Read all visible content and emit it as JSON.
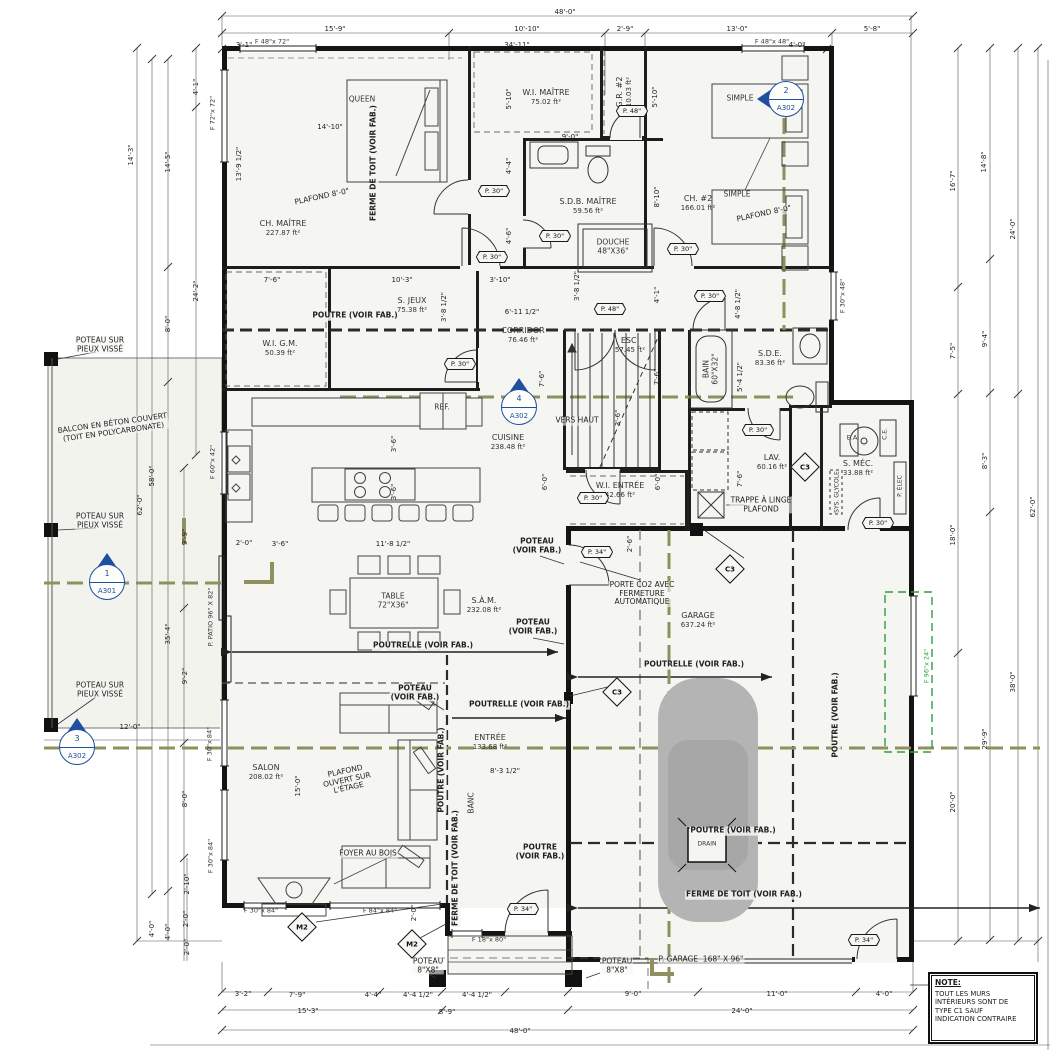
{
  "note": {
    "title": "NOTE:",
    "body": "TOUT LES MURS\nINTÉRIEURS SONT DE\nTYPE C1 SAUF\nINDICATION CONTRAIRE"
  },
  "colors": {
    "accent_blue": "#1e4fa0",
    "section_tan": "#90905e",
    "future_green": "#2e9e3e",
    "wall_black": "#141414",
    "car_gray": "#b4b4b4"
  },
  "rooms": [
    {
      "id": "ch-maitre",
      "name": "CH. MAÎTRE",
      "area": "227.87 ft²",
      "x": 283,
      "y": 228
    },
    {
      "id": "wi-maitre",
      "name": "W.I. MAÎTRE",
      "area": "75.02 ft²",
      "x": 546,
      "y": 97
    },
    {
      "id": "gr-2",
      "name": "G.R. #2",
      "area": "10.03 ft²",
      "x": 624,
      "y": 92,
      "r": -90
    },
    {
      "id": "ch-2",
      "name": "CH. #2",
      "area": "166.01 ft²",
      "x": 698,
      "y": 203
    },
    {
      "id": "sdb-maitre",
      "name": "S.D.B. MAÎTRE",
      "area": "59.56 ft²",
      "x": 588,
      "y": 206
    },
    {
      "id": "s-jeux",
      "name": "S. JEUX",
      "area": "75.38 ft²",
      "x": 412,
      "y": 305
    },
    {
      "id": "wi-gm",
      "name": "W.I. G.M.",
      "area": "50.39 ft²",
      "x": 280,
      "y": 348
    },
    {
      "id": "corridor",
      "name": "CORRIDOR",
      "area": "76.46 ft²",
      "x": 523,
      "y": 335
    },
    {
      "id": "esc",
      "name": "ESC.",
      "area": "57.45 ft²",
      "x": 630,
      "y": 345
    },
    {
      "id": "sde",
      "name": "S.D.E.",
      "area": "83.36 ft²",
      "x": 770,
      "y": 358
    },
    {
      "id": "cuisine",
      "name": "CUISINE",
      "area": "238.48 ft²",
      "x": 508,
      "y": 442
    },
    {
      "id": "wi-entree",
      "name": "W.I. ENTRÉE",
      "area": "42.66 ft²",
      "x": 620,
      "y": 490
    },
    {
      "id": "lav",
      "name": "LAV.",
      "area": "60.16 ft²",
      "x": 772,
      "y": 462
    },
    {
      "id": "s-mec",
      "name": "S. MÉC.",
      "area": "33.88 ft²",
      "x": 858,
      "y": 468
    },
    {
      "id": "sam",
      "name": "S.À.M.",
      "area": "232.08 ft²",
      "x": 484,
      "y": 605
    },
    {
      "id": "garage",
      "name": "GARAGE",
      "area": "637.24 ft²",
      "x": 698,
      "y": 620
    },
    {
      "id": "salon",
      "name": "SALON",
      "area": "208.02 ft²",
      "x": 266,
      "y": 772
    },
    {
      "id": "entree",
      "name": "ENTRÉE",
      "area": "133.68 ft²",
      "x": 490,
      "y": 742
    }
  ],
  "annotations": [
    {
      "t": "POUTRE (VOIR FAB.)",
      "x": 355,
      "y": 316
    },
    {
      "t": "POUTRE (VOIR FAB.)",
      "x": 442,
      "y": 770,
      "r": -90
    },
    {
      "t": "POUTRE\n(VOIR FAB.)",
      "x": 540,
      "y": 852
    },
    {
      "t": "POUTRE (VOIR FAB.)",
      "x": 836,
      "y": 715,
      "r": -90
    },
    {
      "t": "POUTRE (VOIR FAB.)",
      "x": 733,
      "y": 831
    },
    {
      "t": "POUTRELLE (VOIR FAB.)",
      "x": 423,
      "y": 646
    },
    {
      "t": "POUTRELLE (VOIR FAB.)",
      "x": 519,
      "y": 705
    },
    {
      "t": "POUTRELLE (VOIR FAB.)",
      "x": 694,
      "y": 665
    },
    {
      "t": "FERME DE TOIT (VOIR FAB.)",
      "x": 374,
      "y": 163,
      "r": -90
    },
    {
      "t": "FERME DE TOIT (VOIR FAB.)",
      "x": 456,
      "y": 868,
      "r": -90
    },
    {
      "t": "FERME DE TOIT (VOIR FAB.)",
      "x": 744,
      "y": 895
    },
    {
      "t": "POTEAU\n(VOIR FAB.)",
      "x": 537,
      "y": 546
    },
    {
      "t": "POTEAU\n(VOIR FAB.)",
      "x": 533,
      "y": 627
    },
    {
      "t": "POTEAU\n(VOIR FAB.)",
      "x": 415,
      "y": 693
    },
    {
      "t": "POTEAU SUR\nPIEUX VISSÉ",
      "x": 100,
      "y": 345,
      "plain": true
    },
    {
      "t": "POTEAU SUR\nPIEUX VISSÉ",
      "x": 100,
      "y": 521,
      "plain": true
    },
    {
      "t": "POTEAU SUR\nPIEUX VISSÉ",
      "x": 100,
      "y": 690,
      "plain": true
    },
    {
      "t": "POTEAU\n8\"X8\"",
      "x": 428,
      "y": 966,
      "plain": true
    },
    {
      "t": "POTEAU\n8\"X8\"",
      "x": 617,
      "y": 966,
      "plain": true
    },
    {
      "t": "PLAFOND 8'-0\"",
      "x": 322,
      "y": 197,
      "r": -12,
      "plain": true
    },
    {
      "t": "PLAFOND 8'-0\"",
      "x": 764,
      "y": 214,
      "r": -12,
      "plain": true
    },
    {
      "t": "PLAFOND\nOUVERT SUR\nL'ÉTAGE",
      "x": 347,
      "y": 780,
      "r": -12,
      "plain": true
    },
    {
      "t": "BALCON EN BÉTON COUVERT\n(TOIT EN POLYCARBONATE)",
      "x": 113,
      "y": 428,
      "r": -8,
      "plain": true
    },
    {
      "t": "TRAPPE À LINGE\nPLAFOND",
      "x": 761,
      "y": 505,
      "plain": true
    },
    {
      "t": "PORTE CO2 AVEC\nFERMETURE\nAUTOMATIQUE",
      "x": 642,
      "y": 594,
      "plain": true
    },
    {
      "t": "P. GARAGE  168\" X 96\"",
      "x": 701,
      "y": 960,
      "plain": true
    },
    {
      "t": "FOYER AU BOIS",
      "x": 368,
      "y": 854,
      "plain": true
    },
    {
      "t": "VERS HAUT",
      "x": 577,
      "y": 421,
      "plain": true
    }
  ],
  "furniture_labels": [
    {
      "t": "QUEEN",
      "x": 362,
      "y": 100
    },
    {
      "t": "SIMPLE",
      "x": 740,
      "y": 99
    },
    {
      "t": "SIMPLE",
      "x": 737,
      "y": 195
    },
    {
      "t": "TABLE\n72\"X36\"",
      "x": 393,
      "y": 601
    },
    {
      "t": "REF.",
      "x": 442,
      "y": 408
    },
    {
      "t": "DRAIN",
      "x": 707,
      "y": 845,
      "s": 6
    },
    {
      "t": "BANC",
      "x": 472,
      "y": 803,
      "r": -90
    },
    {
      "t": "DOUCHE\n48\"X36\"",
      "x": 613,
      "y": 247
    },
    {
      "t": "BAIN\n60\"X32\"",
      "x": 711,
      "y": 369,
      "r": -90
    },
    {
      "t": "E.A.",
      "x": 853,
      "y": 438,
      "s": 6.5
    },
    {
      "t": "C.E.",
      "x": 886,
      "y": 434,
      "r": -90,
      "s": 6
    },
    {
      "t": "SYS. GLYCOLE",
      "x": 838,
      "y": 492,
      "r": -90,
      "s": 6
    },
    {
      "t": "P. ÉLEC",
      "x": 901,
      "y": 486,
      "r": -90,
      "s": 6
    }
  ],
  "dimensions": [
    {
      "t": "48'-0\"",
      "x": 565,
      "y": 12
    },
    {
      "t": "15'-9\"",
      "x": 335,
      "y": 29
    },
    {
      "t": "10'-10\"",
      "x": 527,
      "y": 29
    },
    {
      "t": "2'-9\"",
      "x": 625,
      "y": 29
    },
    {
      "t": "13'-0\"",
      "x": 737,
      "y": 29
    },
    {
      "t": "5'-8\"",
      "x": 872,
      "y": 29
    },
    {
      "t": "3'-1\"",
      "x": 244,
      "y": 45
    },
    {
      "t": "34'-11\"",
      "x": 517,
      "y": 45
    },
    {
      "t": "4'-0\"",
      "x": 797,
      "y": 45
    },
    {
      "t": "14'-3\"",
      "x": 131,
      "y": 155,
      "r": -90
    },
    {
      "t": "62'-0\"",
      "x": 140,
      "y": 505,
      "r": -90
    },
    {
      "t": "58'-0\"",
      "x": 152,
      "y": 476,
      "r": -90
    },
    {
      "t": "14'-5\"",
      "x": 168,
      "y": 162,
      "r": -90
    },
    {
      "t": "8'-0\"",
      "x": 168,
      "y": 324,
      "r": -90
    },
    {
      "t": "4'-1\"",
      "x": 196,
      "y": 87,
      "r": -90
    },
    {
      "t": "24'-2\"",
      "x": 196,
      "y": 291,
      "r": -90
    },
    {
      "t": "9'-9\"",
      "x": 185,
      "y": 537,
      "r": -90
    },
    {
      "t": "35'-4\"",
      "x": 168,
      "y": 634,
      "r": -90
    },
    {
      "t": "9'-2\"",
      "x": 185,
      "y": 676,
      "r": -90
    },
    {
      "t": "12'-0\"",
      "x": 130,
      "y": 727
    },
    {
      "t": "8'-0\"",
      "x": 185,
      "y": 799,
      "r": -90
    },
    {
      "t": "2'-10\"",
      "x": 187,
      "y": 884,
      "r": -90
    },
    {
      "t": "2'-0\"",
      "x": 186,
      "y": 919,
      "r": -90
    },
    {
      "t": "4'-0\"",
      "x": 152,
      "y": 929,
      "r": -90
    },
    {
      "t": "4'-0\"",
      "x": 168,
      "y": 932,
      "r": -90
    },
    {
      "t": "2'-0\"",
      "x": 187,
      "y": 947,
      "r": -90
    },
    {
      "t": "3'-2\"",
      "x": 243,
      "y": 994
    },
    {
      "t": "7'-9\"",
      "x": 297,
      "y": 995
    },
    {
      "t": "4'-4\"",
      "x": 373,
      "y": 995
    },
    {
      "t": "4'-4 1/2\"",
      "x": 418,
      "y": 995
    },
    {
      "t": "4'-4 1/2\"",
      "x": 477,
      "y": 995
    },
    {
      "t": "9'-0\"",
      "x": 633,
      "y": 994
    },
    {
      "t": "11'-0\"",
      "x": 777,
      "y": 994
    },
    {
      "t": "4'-0\"",
      "x": 884,
      "y": 994
    },
    {
      "t": "15'-3\"",
      "x": 308,
      "y": 1011
    },
    {
      "t": "8'-9\"",
      "x": 447,
      "y": 1012
    },
    {
      "t": "24'-0\"",
      "x": 742,
      "y": 1011
    },
    {
      "t": "48'-0\"",
      "x": 520,
      "y": 1031
    },
    {
      "t": "16'-7\"",
      "x": 953,
      "y": 181,
      "r": -90
    },
    {
      "t": "14'-8\"",
      "x": 984,
      "y": 162,
      "r": -90
    },
    {
      "t": "24'-0\"",
      "x": 1013,
      "y": 229,
      "r": -90
    },
    {
      "t": "7'-5\"",
      "x": 953,
      "y": 351,
      "r": -90
    },
    {
      "t": "9'-4\"",
      "x": 985,
      "y": 339,
      "r": -90
    },
    {
      "t": "8'-3\"",
      "x": 985,
      "y": 461,
      "r": -90
    },
    {
      "t": "62'-0\"",
      "x": 1033,
      "y": 507,
      "r": -90
    },
    {
      "t": "18'-0\"",
      "x": 953,
      "y": 535,
      "r": -90
    },
    {
      "t": "38'-0\"",
      "x": 1013,
      "y": 682,
      "r": -90
    },
    {
      "t": "29'-9\"",
      "x": 985,
      "y": 739,
      "r": -90
    },
    {
      "t": "20'-0\"",
      "x": 953,
      "y": 802,
      "r": -90
    },
    {
      "t": "14'-10\"",
      "x": 330,
      "y": 127
    },
    {
      "t": "13'-9 1/2\"",
      "x": 239,
      "y": 164,
      "r": -90
    },
    {
      "t": "5'-10\"",
      "x": 509,
      "y": 99,
      "r": -90
    },
    {
      "t": "5'-10\"",
      "x": 655,
      "y": 97,
      "r": -90
    },
    {
      "t": "9'-0\"",
      "x": 570,
      "y": 137
    },
    {
      "t": "4'-4\"",
      "x": 509,
      "y": 166,
      "r": -90
    },
    {
      "t": "4'-6\"",
      "x": 509,
      "y": 236,
      "r": -90
    },
    {
      "t": "8'-10\"",
      "x": 657,
      "y": 197,
      "r": -90
    },
    {
      "t": "7'-6\"",
      "x": 272,
      "y": 280
    },
    {
      "t": "10'-3\"",
      "x": 402,
      "y": 280
    },
    {
      "t": "3'-10\"",
      "x": 500,
      "y": 280
    },
    {
      "t": "6'-11 1/2\"",
      "x": 522,
      "y": 312
    },
    {
      "t": "3'-8 1/2\"",
      "x": 444,
      "y": 307,
      "r": -90
    },
    {
      "t": "3'-8 1/2\"",
      "x": 577,
      "y": 286,
      "r": -90
    },
    {
      "t": "4'-1\"",
      "x": 657,
      "y": 295,
      "r": -90
    },
    {
      "t": "4'-8 1/2\"",
      "x": 738,
      "y": 304,
      "r": -90
    },
    {
      "t": "7'-6\"",
      "x": 542,
      "y": 379,
      "r": -90
    },
    {
      "t": "7'-6\"",
      "x": 657,
      "y": 377,
      "r": -90
    },
    {
      "t": "5'-4 1/2\"",
      "x": 740,
      "y": 377,
      "r": -90
    },
    {
      "t": "3'-6\"",
      "x": 618,
      "y": 418,
      "r": -90
    },
    {
      "t": "6'-0\"",
      "x": 545,
      "y": 482,
      "r": -90
    },
    {
      "t": "6'-0\"",
      "x": 658,
      "y": 482,
      "r": -90
    },
    {
      "t": "7'-6\"",
      "x": 740,
      "y": 479,
      "r": -90
    },
    {
      "t": "3'-6\"",
      "x": 394,
      "y": 444,
      "r": -90
    },
    {
      "t": "3'-6\"",
      "x": 394,
      "y": 492,
      "r": -90
    },
    {
      "t": "2'-0\"",
      "x": 244,
      "y": 543
    },
    {
      "t": "3'-6\"",
      "x": 280,
      "y": 544
    },
    {
      "t": "11'-8 1/2\"",
      "x": 393,
      "y": 544
    },
    {
      "t": "15'-0\"",
      "x": 298,
      "y": 786,
      "r": -90
    },
    {
      "t": "8'-3 1/2\"",
      "x": 505,
      "y": 771
    },
    {
      "t": "2'-6\"",
      "x": 630,
      "y": 544,
      "r": -90
    },
    {
      "t": "2'-0\"",
      "x": 414,
      "y": 913,
      "r": -90
    }
  ],
  "door_tags": [
    {
      "t": "P. 30\"",
      "x": 494,
      "y": 191
    },
    {
      "t": "P. 30\"",
      "x": 555,
      "y": 236
    },
    {
      "t": "P. 30\"",
      "x": 492,
      "y": 257
    },
    {
      "t": "P. 30\"",
      "x": 683,
      "y": 249
    },
    {
      "t": "P. 30\"",
      "x": 710,
      "y": 296
    },
    {
      "t": "P. 30\"",
      "x": 460,
      "y": 364
    },
    {
      "t": "P. 48\"",
      "x": 632,
      "y": 111
    },
    {
      "t": "P. 48\"",
      "x": 610,
      "y": 309
    },
    {
      "t": "P. 30\"",
      "x": 758,
      "y": 430
    },
    {
      "t": "P. 30\"",
      "x": 593,
      "y": 498
    },
    {
      "t": "P. 30\"",
      "x": 878,
      "y": 523
    },
    {
      "t": "P. 34\"",
      "x": 597,
      "y": 552
    },
    {
      "t": "P. 34\"",
      "x": 523,
      "y": 909
    },
    {
      "t": "P. 34\"",
      "x": 864,
      "y": 940
    }
  ],
  "window_tags": [
    {
      "t": "F 48\"x 72\"",
      "x": 272,
      "y": 42
    },
    {
      "t": "F 48\"x 48\"",
      "x": 772,
      "y": 42
    },
    {
      "t": "F 72\"x 72\"",
      "x": 213,
      "y": 113,
      "r": -90
    },
    {
      "t": "F 30\"x 48\"",
      "x": 843,
      "y": 296,
      "r": -90
    },
    {
      "t": "F 60\"x 42\"",
      "x": 213,
      "y": 462,
      "r": -90
    },
    {
      "t": "P. PATIO 96\" X 82\"",
      "x": 211,
      "y": 617,
      "r": -90
    },
    {
      "t": "F 30\"x 84\"",
      "x": 210,
      "y": 744,
      "r": -90
    },
    {
      "t": "F 30\"x 84\"",
      "x": 211,
      "y": 856,
      "r": -90
    },
    {
      "t": "F 30\"x 84\"",
      "x": 261,
      "y": 911
    },
    {
      "t": "F 84\"x 84\"",
      "x": 380,
      "y": 911
    },
    {
      "t": "F 18\"x 80\"",
      "x": 489,
      "y": 940
    },
    {
      "t": "F 96\"x 24\"",
      "x": 927,
      "y": 666,
      "r": -90,
      "green": true
    }
  ],
  "wall_tags": [
    {
      "t": "C3",
      "x": 805,
      "y": 467
    },
    {
      "t": "C3",
      "x": 730,
      "y": 569
    },
    {
      "t": "C3",
      "x": 617,
      "y": 692
    },
    {
      "t": "M2",
      "x": 302,
      "y": 927
    },
    {
      "t": "M2",
      "x": 412,
      "y": 944
    }
  ],
  "section_markers": [
    {
      "num": "1",
      "sheet": "A301",
      "x": 107,
      "y": 582,
      "dir": "up"
    },
    {
      "num": "2",
      "sheet": "A302",
      "x": 786,
      "y": 99,
      "dir": "left"
    },
    {
      "num": "3",
      "sheet": "A302",
      "x": 77,
      "y": 747,
      "dir": "up"
    },
    {
      "num": "4",
      "sheet": "A302",
      "x": 519,
      "y": 407,
      "dir": "up"
    }
  ]
}
